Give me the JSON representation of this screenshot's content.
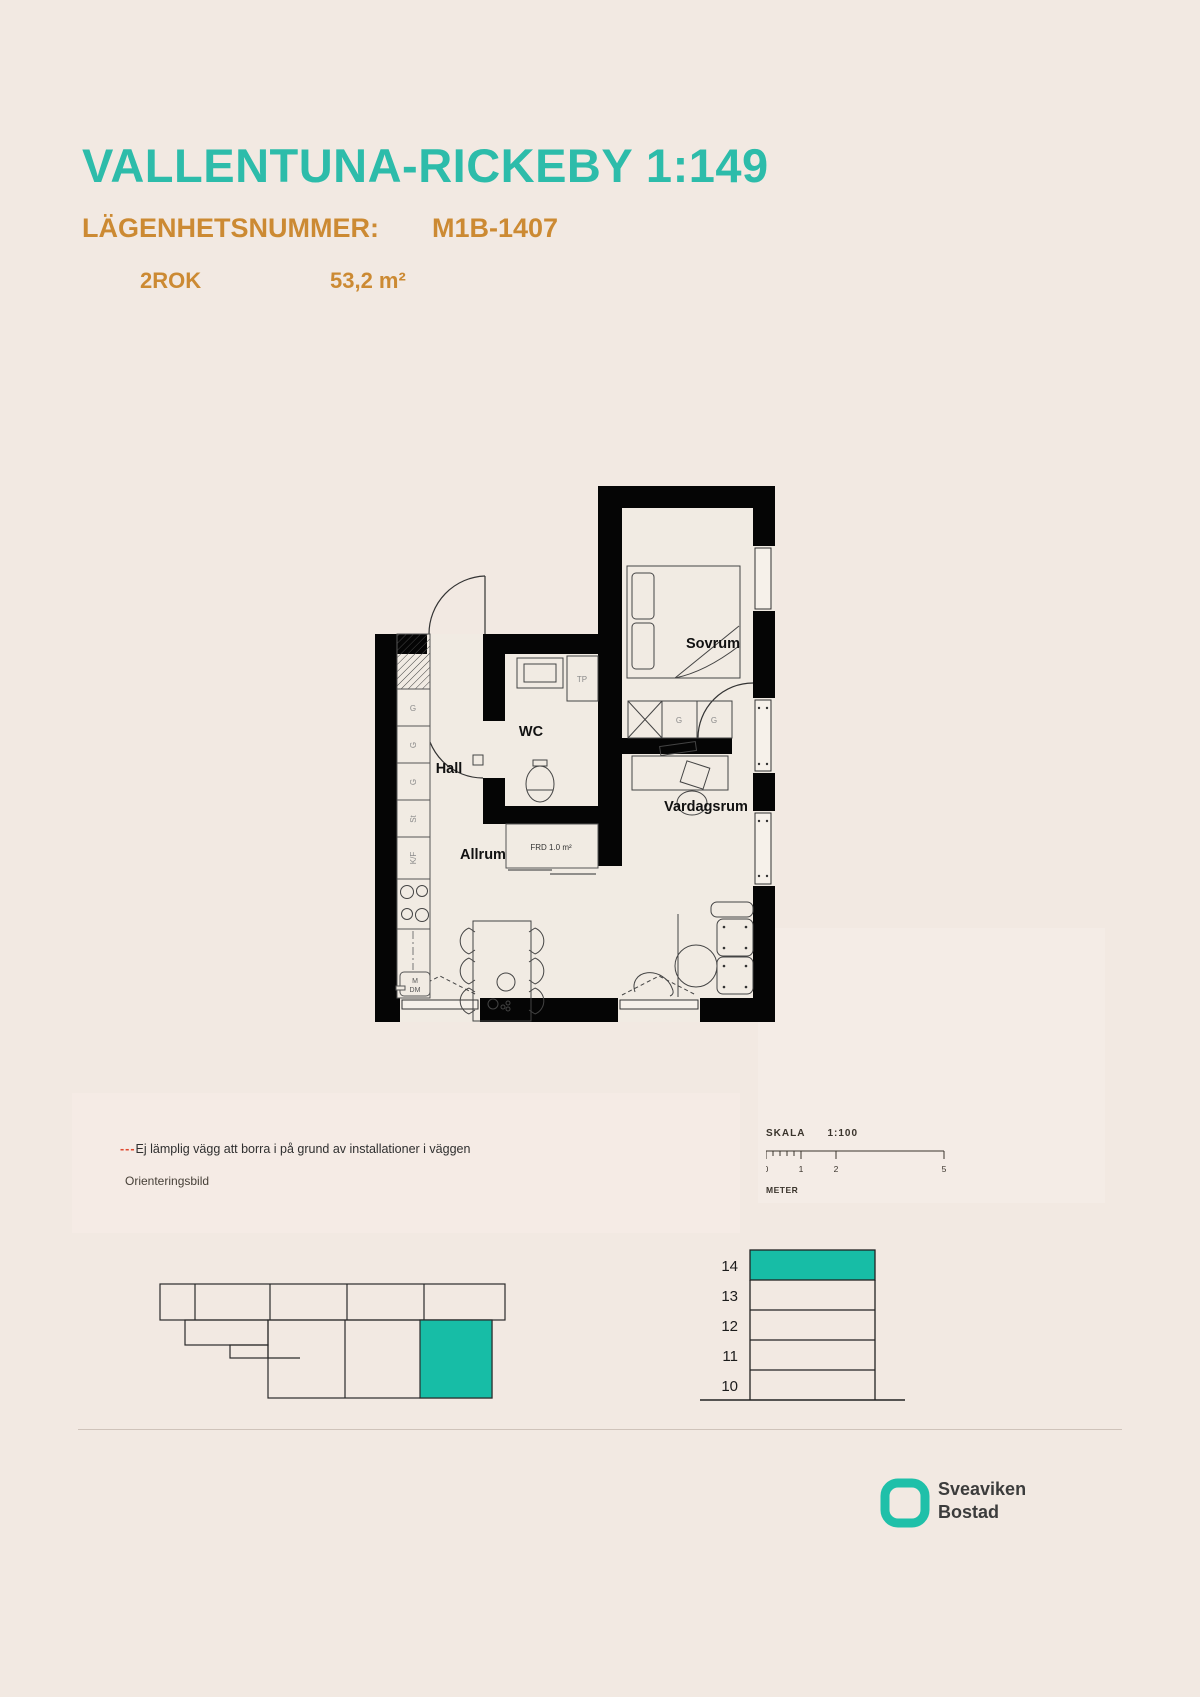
{
  "header": {
    "title": "VALLENTUNA-RICKEBY 1:149",
    "apartment_label": "LÄGENHETSNUMMER:",
    "apartment_number": "M1B-1407",
    "rooms": "2ROK",
    "area": "53,2 m²",
    "title_color": "#2dbcaa",
    "accent_color": "#cc8a33"
  },
  "floorplan": {
    "labels": {
      "sovrum": "Sovrum",
      "hall": "Hall",
      "wc": "WC",
      "vardagsrum": "Vardagsrum",
      "allrum": "Allrum",
      "tp": "TP",
      "frd": "FRD 1.0 m²",
      "g": "G",
      "st": "St",
      "kf": "K/F",
      "m": "M",
      "dm": "DM"
    }
  },
  "note": {
    "dashes": "---",
    "warning": "Ej lämplig vägg att borra i på grund av installationer i väggen",
    "orientation": "Orienteringsbild",
    "warning_color": "#e0482f"
  },
  "scalebar": {
    "label": "SKALA",
    "ratio": "1:100",
    "t0": "0",
    "t1": "1",
    "t2": "2",
    "t5": "5",
    "unit": "METER"
  },
  "floors": {
    "levels": [
      "14",
      "13",
      "12",
      "11",
      "10"
    ],
    "highlighted": "14",
    "highlight_color": "#17bda6"
  },
  "logo": {
    "line1": "Sveaviken",
    "line2": "Bostad",
    "icon_color": "#1fc0a9"
  }
}
